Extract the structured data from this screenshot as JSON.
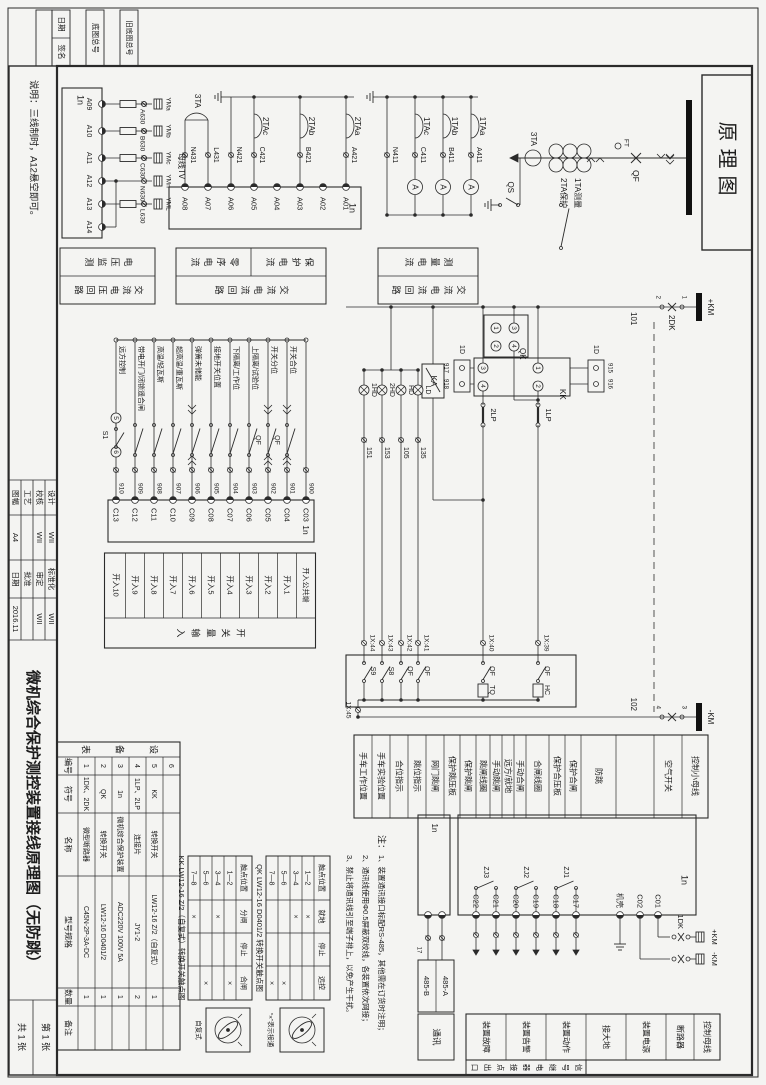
{
  "frame": {
    "principle_title": "原理图",
    "note_left": "说明：三线制时，A12悬空即可。",
    "margin_boxes": {
      "old_base": "旧底图总号",
      "base": "底图总号",
      "date": "日期",
      "sign": "签名"
    },
    "title_block": {
      "cells": [
        [
          "设计",
          "WII",
          "标准化",
          "WII"
        ],
        [
          "校核",
          "WII",
          "审定",
          "WII"
        ],
        [
          "工艺",
          "",
          "批准",
          ""
        ],
        [
          "图幅",
          "A4",
          "日期",
          "2016.11"
        ]
      ],
      "main_title": "微机综合保护测控装置接线原理图（无防跳）",
      "sheet_no": "第 1 张",
      "sheet_total": "共 1 张"
    }
  },
  "primary": {
    "breaker": "QF",
    "ft": "FT",
    "ct_meas": "1TA测量",
    "ct_prot": "2TA保护",
    "zero_ct": "3TA",
    "earth_switch": "QS",
    "bus_tv": "母线TV"
  },
  "section_boxes": {
    "meas_col1": "测量电流",
    "meas_col2": "交流电流回路",
    "prot_top": "保护电流",
    "prot_bottom": "零序电流",
    "prot_col2": "交流电流回路",
    "volt_col1": "电压监测",
    "volt_col2": "交流电压回路"
  },
  "measurement": {
    "cts": [
      "1TAa",
      "1TAb",
      "1TAc"
    ],
    "wires": [
      "A411",
      "B411",
      "C411"
    ],
    "neutral_wire": "N411",
    "meter": "A"
  },
  "protection": {
    "device": "1n",
    "cts": [
      "2TAa",
      "2TAb",
      "2TAc"
    ],
    "zero": "3TA",
    "phase_wires": [
      "A421",
      "B421",
      "C421"
    ],
    "neutral_wire": "N421",
    "zero_wires": [
      "L431",
      "N431"
    ],
    "terminals": [
      "A01",
      "A02",
      "A03",
      "A04",
      "A05",
      "A06",
      "A07",
      "A08"
    ]
  },
  "voltage": {
    "device": "1n",
    "terminals": [
      "A09",
      "A10",
      "A11",
      "A12",
      "A13",
      "A14"
    ],
    "fuse_wires": [
      "A630",
      "B630",
      "C630",
      "N630",
      "L630"
    ],
    "taps": [
      "YMa",
      "YMb",
      "YMc",
      "YMn",
      "YML"
    ]
  },
  "binary": {
    "device": "1n",
    "table_title": "开关量输入",
    "common": {
      "terminal": "C03",
      "wire": "900",
      "input": "开入公共端"
    },
    "rows": [
      {
        "terminal": "C04",
        "wire": "901",
        "label": "开关合位",
        "sw": "QF",
        "chev": true,
        "input": "开入1"
      },
      {
        "terminal": "C05",
        "wire": "902",
        "label": "开关分位",
        "sw": "QF",
        "chev": true,
        "input": "开入2"
      },
      {
        "terminal": "C06",
        "wire": "903",
        "label": "上隔离/试验位",
        "input": "开入3"
      },
      {
        "terminal": "C07",
        "wire": "904",
        "label": "下隔离/工作位",
        "input": "开入4"
      },
      {
        "terminal": "C08",
        "wire": "905",
        "label": "接地开关位置",
        "input": "开入5"
      },
      {
        "terminal": "C09",
        "wire": "906",
        "label": "弹簧未储能",
        "chev": true,
        "input": "开入6"
      },
      {
        "terminal": "C10",
        "wire": "907",
        "label": "超高温/重瓦斯",
        "input": "开入7"
      },
      {
        "terminal": "C11",
        "wire": "908",
        "label": "高温/轻瓦斯",
        "input": "开入8"
      },
      {
        "terminal": "C12",
        "wire": "909",
        "label": "带电开门/闭锁遥合闸",
        "input": "开入9"
      },
      {
        "terminal": "C13",
        "wire": "910",
        "label": "远方控制",
        "sw": "S1",
        "nums": [
          "5",
          "6"
        ],
        "input": "开入10"
      }
    ]
  },
  "control": {
    "bus_pos": "+KM",
    "bus_neg": "-KM",
    "breaker": "2DK",
    "pole_nums": [
      "1",
      "2",
      "3",
      "4"
    ],
    "wire_pos": "101",
    "wire_neg": "102",
    "qk": "QK",
    "kk": "KK",
    "relay": "KA",
    "qk_nums": [
      "3",
      "4",
      "1",
      "2"
    ],
    "kk_nums": [
      "1",
      "2",
      "3",
      "4"
    ],
    "links": [
      "1LP",
      "2LP"
    ],
    "tb": "1D",
    "tb1_nums": [
      "915",
      "916"
    ],
    "tb2_nums": [
      "917",
      "918"
    ],
    "lamps": [
      {
        "label": "LD",
        "wire": "135"
      },
      {
        "label": "HD",
        "wire": "105"
      },
      {
        "label": "2HD",
        "wire": "153"
      },
      {
        "label": "1HD",
        "wire": "151"
      }
    ],
    "mech": {
      "rows": [
        {
          "term": "1X:39",
          "sw": "QF",
          "coil": "HC"
        },
        {
          "term": "1X:40",
          "sw": "QF",
          "coil": "TQ"
        },
        {
          "term": "1X:41",
          "sw": "QF"
        },
        {
          "term": "1X:42",
          "sw": "QF"
        },
        {
          "term": "1X:43",
          "sw": "S8"
        },
        {
          "term": "1X:44",
          "sw": "S9"
        }
      ],
      "common_term": "1X:45"
    },
    "row_labels": [
      "控制小母线",
      "空气开关",
      "",
      "防跳",
      "保护合闸",
      "保护合压板",
      "合闸线圈",
      "手动合闸",
      "远方/就地",
      "手动跳闸",
      "跳闸线圈",
      "保护跳闸",
      "保护跳压板",
      "网门跳闸",
      "跳位指示",
      "合位指示",
      "手车实验位置",
      "手车工作位置"
    ]
  },
  "device": {
    "label": "1n",
    "power_terms": [
      "C01",
      "C02"
    ],
    "chassis": "机壳",
    "breaker": "1DK",
    "taps": [
      "+KM",
      "-KM"
    ],
    "out_terms": [
      "C17",
      "C18",
      "C19",
      "C20",
      "C21",
      "C22"
    ],
    "out_relays": [
      "ZJ1",
      "ZJ2",
      "ZJ3"
    ],
    "comm_label": "1n",
    "comm_cells": [
      "485-A",
      "485-B"
    ],
    "comm_num": "17",
    "col_labels": [
      "控制母线",
      "断路器",
      "装置电源",
      "接大地",
      "装置动作",
      "装置告警",
      "装置故障"
    ],
    "signal_note": "信号继电器接点出口",
    "comm_cell": "通讯"
  },
  "notes": {
    "head": "注：",
    "lines": [
      "1、装置通讯接口标配RS-485，其他需在订货时注明；",
      "2、通讯线使用Φ0.5屏蔽双绞线，各装置依次网接；",
      "3、禁止将通讯线引至端子排上，以免产生干扰。"
    ]
  },
  "contact_tables": {
    "qk": {
      "title": "QK  LW12-16 D0401/2  转换开关触点图",
      "note": "“×”表示接通",
      "cols": [
        "触点位置",
        "就地",
        "停止",
        "远控"
      ],
      "rows": [
        [
          "1—2",
          "×",
          "",
          ""
        ],
        [
          "3—4",
          "×",
          "",
          ""
        ],
        [
          "5—6",
          "",
          "",
          "×"
        ],
        [
          "7—8",
          "",
          "",
          "×"
        ]
      ]
    },
    "kk": {
      "title": "KK  LW12-16 Z/2（自复式）转换开关触点图",
      "note": "自复式",
      "cols": [
        "触点位置",
        "分闸",
        "停止",
        "合闸"
      ],
      "rows": [
        [
          "1—2",
          "",
          "",
          "×"
        ],
        [
          "3—4",
          "×",
          "",
          ""
        ],
        [
          "5—6",
          "",
          "",
          "×"
        ],
        [
          "7—8",
          "×",
          "",
          ""
        ]
      ]
    }
  },
  "equipment_table": {
    "caption": "设备表",
    "headers": [
      "编号",
      "符号",
      "名称",
      "型号规格",
      "数量",
      "备注"
    ],
    "rows": [
      [
        "6",
        "",
        "",
        "",
        "",
        ""
      ],
      [
        "5",
        "KK",
        "转换开关",
        "LW12-16 Z/2（自复式）",
        "1",
        ""
      ],
      [
        "4",
        "1LP、2LP",
        "连接片",
        "JY1-2",
        "2",
        ""
      ],
      [
        "3",
        "1n",
        "微机综合保护装置",
        "ADC220V 100V 5A",
        "1",
        ""
      ],
      [
        "2",
        "QK",
        "转换开关",
        "LW12-16 D0401/2",
        "1",
        ""
      ],
      [
        "1",
        "1DK、2DK",
        "微型断路器",
        "C45N-2P-3A-DC",
        "1",
        ""
      ]
    ]
  }
}
